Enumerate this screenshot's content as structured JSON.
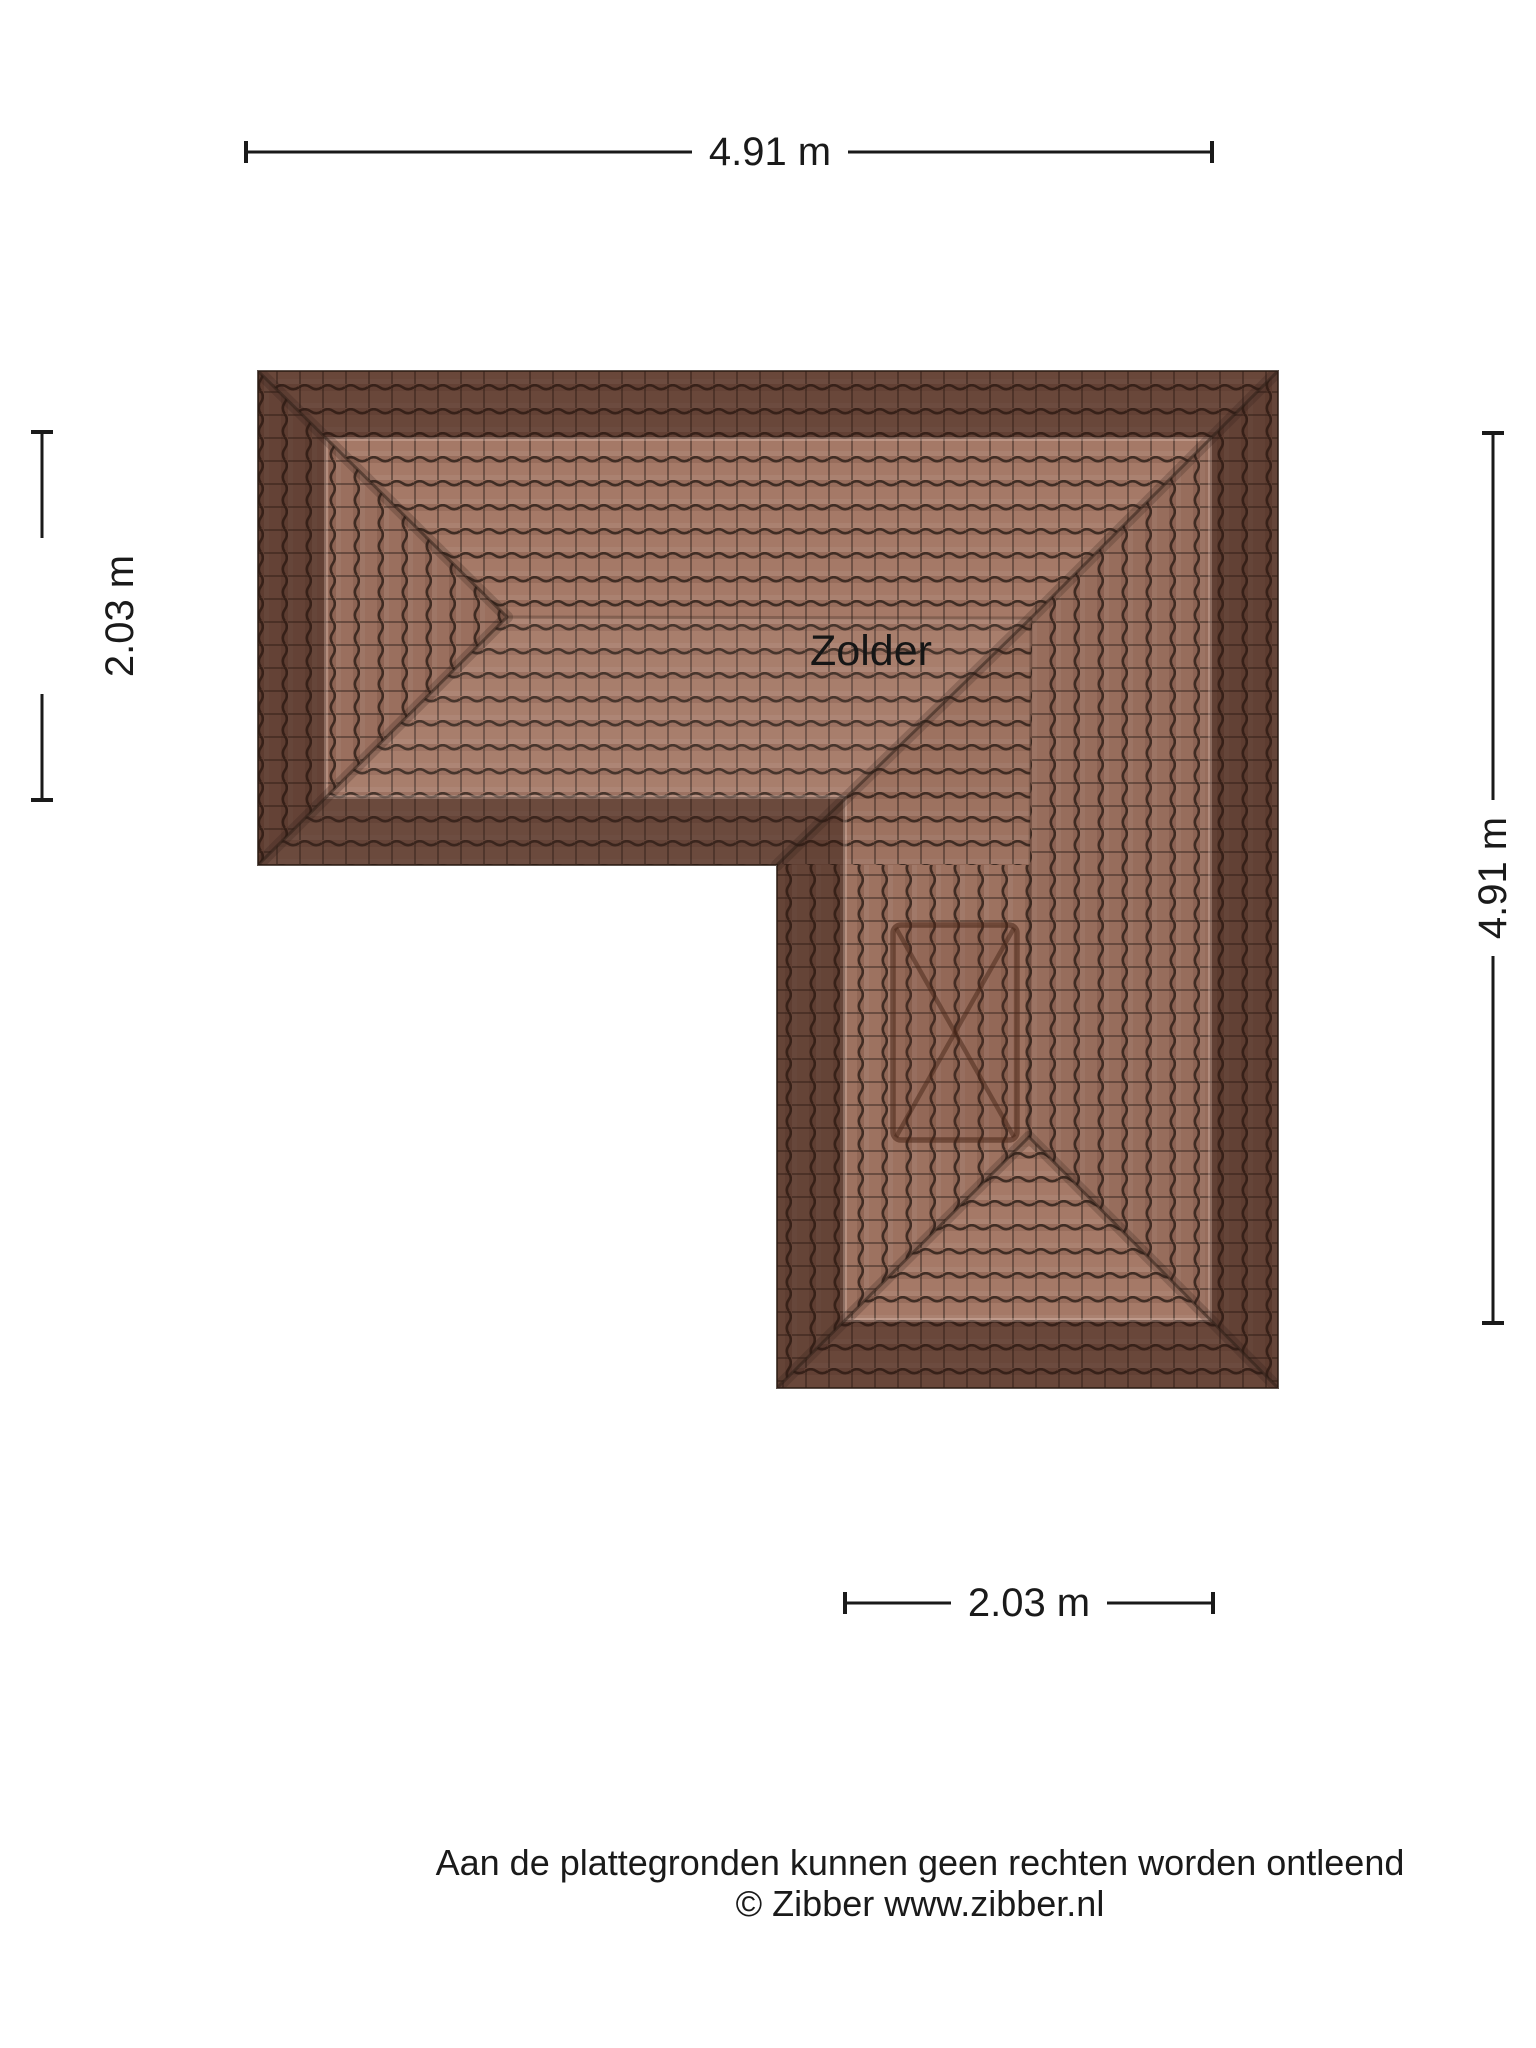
{
  "floorplan": {
    "room_label": "Zolder",
    "dimensions": {
      "top": "4.91 m",
      "left": "2.03 m",
      "right": "4.91 m",
      "bottom": "2.03 m"
    },
    "footer": {
      "line1": "Aan de plattegronden kunnen geen rechten worden ontleend",
      "line2": "© Zibber www.zibber.nl"
    },
    "colors": {
      "tile_field": "#a57967",
      "tile_groove": "#2a1d17",
      "eave_band_overlay": "rgba(46,21,14,0.50)",
      "text": "#1a1a1a"
    }
  }
}
